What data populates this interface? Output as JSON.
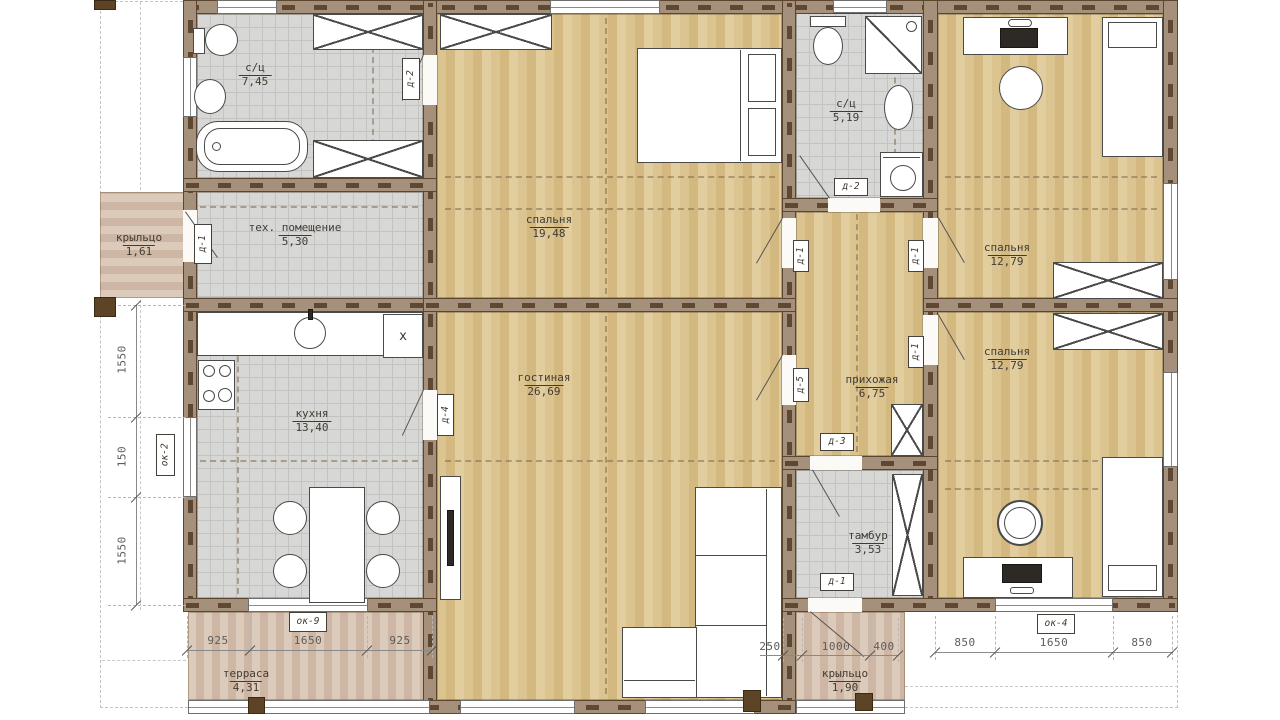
{
  "rooms": {
    "bath1": {
      "name": "с/ц",
      "area": "7,45"
    },
    "tech": {
      "name": "тех. помещение",
      "area": "5,30"
    },
    "kitchen": {
      "name": "кухня",
      "area": "13,40"
    },
    "bedroom_main": {
      "name": "спальня",
      "area": "19,48"
    },
    "bath2": {
      "name": "с/ц",
      "area": "5,19"
    },
    "hallway": {
      "name": "прихожая",
      "area": "6,75"
    },
    "living": {
      "name": "гостиная",
      "area": "26,69"
    },
    "bedroom_top": {
      "name": "спальня",
      "area": "12,79"
    },
    "bedroom_bottom": {
      "name": "спальня",
      "area": "12,79"
    },
    "tambour": {
      "name": "тамбур",
      "area": "3,53"
    },
    "porch_left": {
      "name": "крыльцо",
      "area": "1,61"
    },
    "porch_bottom": {
      "name": "крыльцо",
      "area": "1,90"
    },
    "terrace": {
      "name": "терраса",
      "area": "4,31"
    }
  },
  "door_tags": {
    "d1": "д-1",
    "d2": "д-2",
    "d3": "д-3",
    "d4": "д-4",
    "d5": "д-5"
  },
  "window_tags": {
    "ok2": "ок-2",
    "ok4": "ок-4",
    "ok9": "ок-9"
  },
  "appliance_tags": {
    "fridge": "x"
  },
  "dimensions": {
    "left_chain": [
      "1550",
      "150",
      "1550"
    ],
    "terrace_chain": [
      "925",
      "1650",
      "925"
    ],
    "entry_chain": [
      "250",
      "1000",
      "400"
    ],
    "right_chain": [
      "850",
      "1650",
      "850"
    ]
  }
}
